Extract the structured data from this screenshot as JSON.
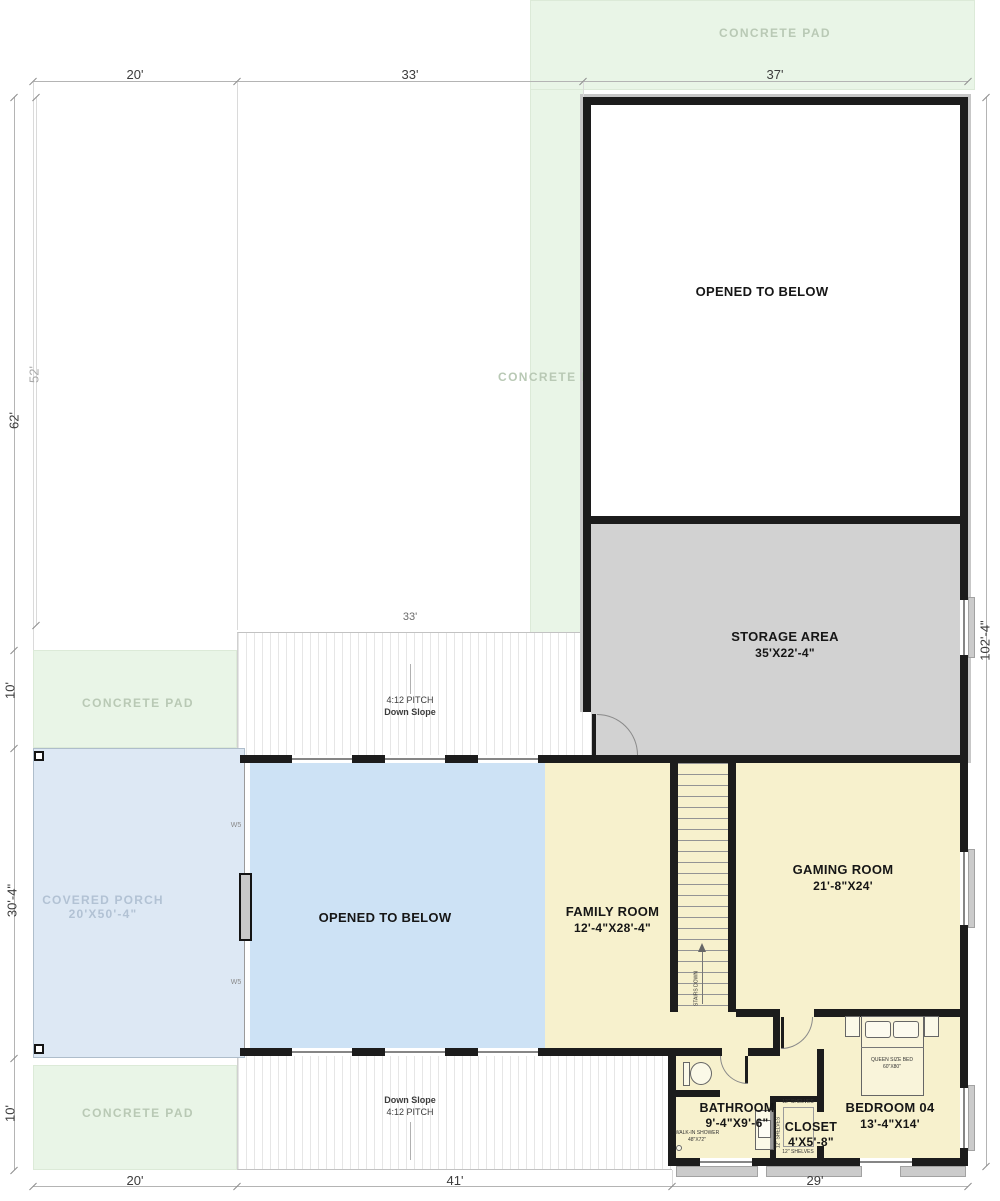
{
  "colors": {
    "wall": "#1c1c1c",
    "concrete_pad_green": "#e9f5e7",
    "storage_gray": "#d2d2d2",
    "floor_yellow": "#f7f1cd",
    "porch_blue": "#dde8f4",
    "open_below_blue": "#cde2f5",
    "pad_text": "#b9c9b5",
    "porch_text": "#b2c2d4"
  },
  "rooms": {
    "opened_upper": {
      "name": "OPENED TO BELOW"
    },
    "storage": {
      "name": "STORAGE AREA",
      "size": "35'X22'-4\""
    },
    "family": {
      "name": "FAMILY ROOM",
      "size": "12'-4\"X28'-4\""
    },
    "gaming": {
      "name": "GAMING ROOM",
      "size": "21'-8\"X24'"
    },
    "opened_lower": {
      "name": "OPENED TO BELOW"
    },
    "porch": {
      "name": "COVERED PORCH",
      "size": "20'X50'-4\""
    },
    "bathroom": {
      "name": "BATHROOM",
      "size": "9'-4\"X9'-6\""
    },
    "closet": {
      "name": "CLOSET",
      "size": "4'X5'-8\""
    },
    "bedroom": {
      "name": "BEDROOM 04",
      "size": "13'-4\"X14'"
    }
  },
  "pads": {
    "top": "CONCRETE PAD",
    "behind": "CONCRETE PAD",
    "mid": "CONCRETE PAD",
    "bottom": "CONCRETE PAD"
  },
  "fixtures": {
    "shower": {
      "l1": "WALK-IN SHOWER",
      "l2": "48\"X72\""
    },
    "bed": {
      "l1": "QUEEN SIZE BED",
      "l2": "60\"X80\""
    },
    "shelves_top": "12\" SHELVES",
    "shelves_side": "12\" SHELVES",
    "shelves_bottom": "12\" SHELVES",
    "stairs": "STAIRS DOWN",
    "w5_upper": "W5",
    "w5_lower": "W5"
  },
  "slopes": {
    "top": {
      "l1": "4:12 PITCH",
      "l2": "Down Slope"
    },
    "bottom": {
      "l1": "Down Slope",
      "l2": "4:12 PITCH"
    }
  },
  "dims": {
    "top_20": "20'",
    "top_33": "33'",
    "top_37": "37'",
    "left_62": "62'",
    "left_52": "52'",
    "left_10_mid": "10'",
    "left_30_4": "30'-4\"",
    "left_10_bot": "10'",
    "right_102": "102'-4\"",
    "mid_33": "33'",
    "bot_20": "20'",
    "bot_41": "41'",
    "bot_29": "29'"
  }
}
